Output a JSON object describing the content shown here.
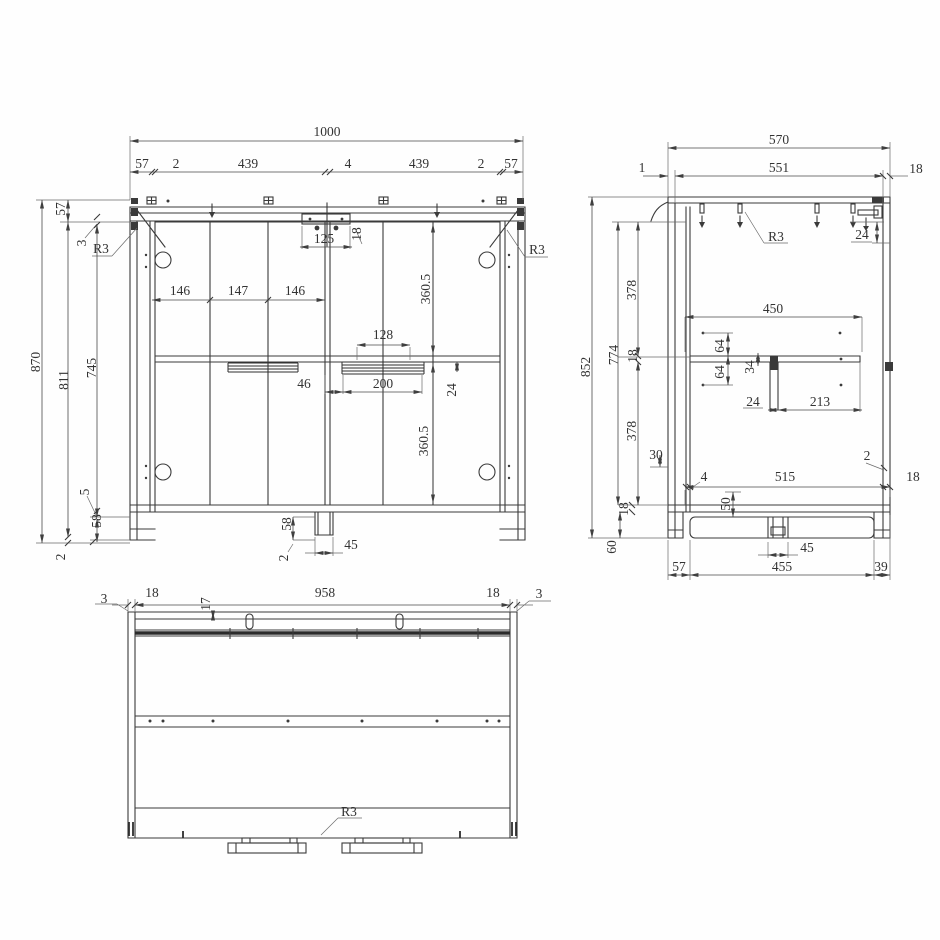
{
  "drawing": {
    "front": {
      "overall_width": "1000",
      "top_row": [
        "57",
        "2",
        "439",
        "4",
        "439",
        "2",
        "57"
      ],
      "overall_height": "870",
      "h_811": "811",
      "h_745": "745",
      "v_57": "57",
      "v_3": "3",
      "v_5": "5",
      "v_58": "58",
      "v_2": "2",
      "corner_radius_left": "R3",
      "corner_radius_right": "R3",
      "bracket_width": "125",
      "bracket_offset": "18",
      "hinge_spacing": [
        "146",
        "147",
        "146"
      ],
      "door_height_upper": "360.5",
      "door_height_lower": "360.5",
      "slide_width": "128",
      "gap_46": "46",
      "slide_length": "200",
      "d_24": "24",
      "foot_height": "58",
      "foot_gap": "2",
      "foot_width": "45"
    },
    "side": {
      "overall_depth": "570",
      "top_551": "551",
      "gap_1": "1",
      "back_18": "18",
      "corner_radius": "R3",
      "rail_24": "24",
      "overall_height": "852",
      "h_774": "774",
      "upper_378": "378",
      "shelf_18": "18",
      "lower_378": "378",
      "d_30": "30",
      "bottom_18": "18",
      "plinth_60": "60",
      "shelf_450": "450",
      "hole_64_up": "64",
      "hole_64_dn": "64",
      "d_34": "34",
      "support_24": "24",
      "d_213": "213",
      "gap_4": "4",
      "bottom_515": "515",
      "gap_2": "2",
      "front_18": "18",
      "d_50": "50",
      "back_57": "57",
      "plinth_455": "455",
      "foot_45": "45",
      "front_39": "39",
      "slot_17_unused": ""
    },
    "bottom": {
      "edge_3_left": "3",
      "panel_18_left": "18",
      "width_958": "958",
      "panel_18_right": "18",
      "edge_3_right": "3",
      "slot_17": "17",
      "corner_radius": "R3"
    }
  }
}
